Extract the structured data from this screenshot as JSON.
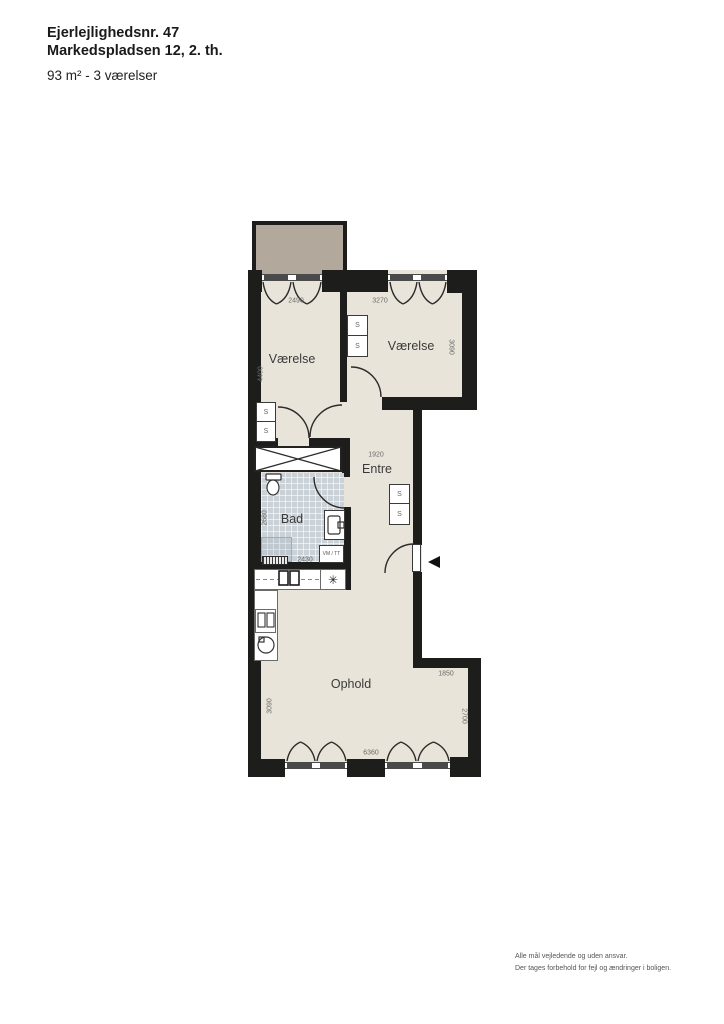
{
  "header": {
    "line1": "Ejerlejlighedsnr. 47",
    "line2": "Markedspladsen 12, 2. th.",
    "line3": "93 m² - 3 værelser"
  },
  "footer": {
    "line1": "Alle mål vejledende og uden ansvar.",
    "line2": "Der tages forbehold for fejl og ændringer i boligen."
  },
  "rooms": {
    "bedroom1": "Værelse",
    "bedroom2": "Værelse",
    "entry": "Entre",
    "bath": "Bad",
    "living": "Ophold"
  },
  "dims": {
    "bedroom1_width": "2490",
    "bedroom1_depth": "4400",
    "bedroom2_width": "3270",
    "bedroom2_depth": "3090",
    "entry_width": "1920",
    "bath_depth": "2680",
    "bath_width": "2430",
    "living_ext_width": "1850",
    "living_ext_depth": "2700",
    "living_depth": "3090",
    "living_width": "6360"
  },
  "labels": {
    "closet": "S",
    "washer": "VM / TT",
    "freezer_symbol": "✳"
  },
  "colors": {
    "wall": "#1d1d1b",
    "floor": "#e9e4d9",
    "balcony": "#b2a89b",
    "bath_tile": "#cbd2d7",
    "window_frame": "#4a4a4a",
    "dim_text": "#6a6a6a",
    "label_text": "#3a3a3a"
  }
}
